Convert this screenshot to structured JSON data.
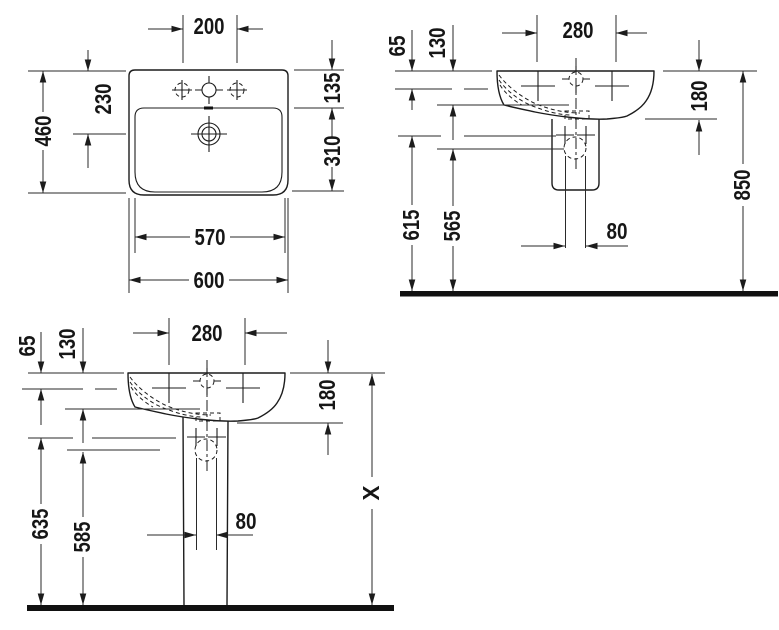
{
  "page": {
    "background": "#ffffff"
  },
  "drawing": {
    "type": "washbasin technical dimension drawing",
    "line_color": "#1c1c1c",
    "views": {
      "plan": {
        "name": "washbasin-top-view",
        "dims": {
          "tap_hole_spacing": "200",
          "overall_depth": "460",
          "rim_to_drain": "230",
          "rim_to_basin": "135",
          "basin_depth": "310",
          "basin_width": "570",
          "overall_width": "600"
        }
      },
      "wall": {
        "name": "washbasin-wall-mounted-elevation",
        "dims": {
          "rim_to_inner_edge": "65",
          "rim_to_bowl": "130",
          "fixing_hole_spacing": "280",
          "apron_height": "180",
          "fixing_height": "615",
          "drain_height": "565",
          "outlet_spacing": "80",
          "rim_height": "850"
        }
      },
      "pedestal": {
        "name": "washbasin-pedestal-elevation",
        "dims": {
          "rim_to_inner_edge": "65",
          "rim_to_bowl": "130",
          "fixing_hole_spacing": "280",
          "apron_height": "180",
          "fixing_height": "635",
          "drain_height": "585",
          "outlet_spacing": "80",
          "total_height": "X"
        }
      }
    }
  }
}
